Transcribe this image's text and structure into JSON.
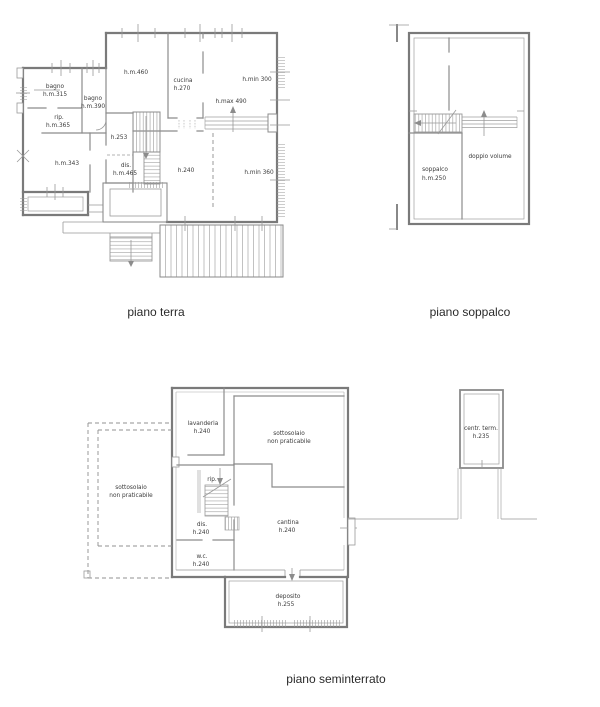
{
  "document": {
    "type": "architectural-floor-plan",
    "background": "#ffffff"
  },
  "palette": {
    "exterior_wall": "#7a7a7a",
    "interior_wall": "#8c8c8c",
    "thin_line": "#999999",
    "hatch": "#a8a8a8",
    "dashed_line": "#909090",
    "label_text": "#3a3a3a",
    "title_text": "#2a2a2a"
  },
  "plans": {
    "terra": {
      "title": "piano terra",
      "labels": {
        "bagno1": [
          "bagno",
          "h.m.315"
        ],
        "bagno2": [
          "bagno",
          "h.m.390"
        ],
        "rip": [
          "rip.",
          "h.m.365"
        ],
        "room343": [
          "h.m.343"
        ],
        "room460": [
          "h.m.460"
        ],
        "cucina": [
          "cucina",
          "h.270"
        ],
        "hmin300": [
          "h.min 300"
        ],
        "hmax490": [
          "h.max 490"
        ],
        "h253": [
          "h.253"
        ],
        "dis": [
          "dis.",
          "h.m.465"
        ],
        "h240": [
          "h.240"
        ],
        "hmin360": [
          "h.min 360"
        ]
      }
    },
    "soppalco": {
      "title": "piano soppalco",
      "labels": {
        "soppalco": [
          "soppalco",
          "h.m.250"
        ],
        "doppio": [
          "doppio volume"
        ]
      }
    },
    "seminterrato": {
      "title": "piano seminterrato",
      "labels": {
        "lavanderia": [
          "lavanderia",
          "h.240"
        ],
        "sottosolaio_top": [
          "sottosolaio",
          "non praticabile"
        ],
        "sottosolaio_left": [
          "sottosolaio",
          "non praticabile"
        ],
        "rip": [
          "rip."
        ],
        "dis": [
          "dis.",
          "h.240"
        ],
        "wc": [
          "w.c.",
          "h.240"
        ],
        "cantina": [
          "cantina",
          "h.240"
        ],
        "deposito": [
          "deposito",
          "h.255"
        ],
        "centrale": [
          "centr. term.",
          "h.235"
        ]
      }
    }
  }
}
